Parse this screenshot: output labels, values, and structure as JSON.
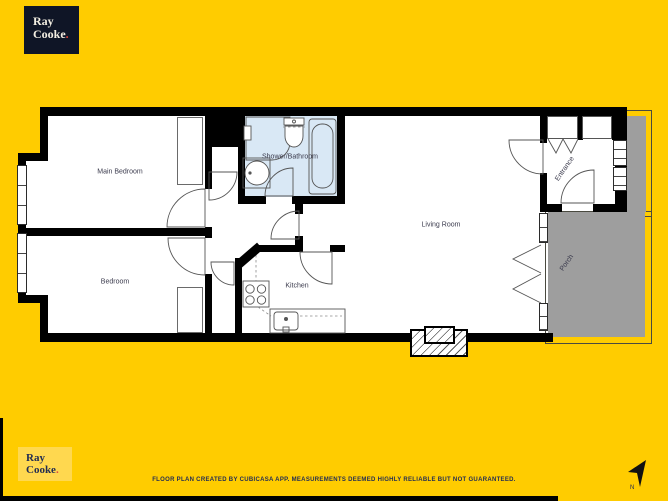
{
  "background_color": "#FFCC00",
  "floor_plan": {
    "colors": {
      "wall": "#000000",
      "floor": "#FFFFFF",
      "bathroom_floor": "#D9E8F5",
      "porch": "#9E9E9E"
    },
    "rooms": [
      {
        "id": "main-bedroom",
        "label": "Main Bedroom"
      },
      {
        "id": "bedroom",
        "label": "Bedroom"
      },
      {
        "id": "shower-bathroom",
        "label": "Shower/Bathroom"
      },
      {
        "id": "kitchen",
        "label": "Kitchen"
      },
      {
        "id": "living-room",
        "label": "Living Room"
      },
      {
        "id": "entrance",
        "label": "Entrance"
      },
      {
        "id": "porch",
        "label": "Porch"
      }
    ]
  },
  "branding": {
    "name_line1": "Ray",
    "name_line2": "Cooke",
    "period": ".",
    "logo_top_bg": "#0f1526",
    "logo_bottom_bg": "#ffd84f",
    "period_color": "#e0493f",
    "text_color": "#232d52"
  },
  "footer": {
    "disclaimer": "FLOOR PLAN CREATED BY CUBICASA APP. MEASUREMENTS DEEMED HIGHLY RELIABLE BUT NOT GUARANTEED."
  },
  "compass": {
    "label": "N"
  }
}
